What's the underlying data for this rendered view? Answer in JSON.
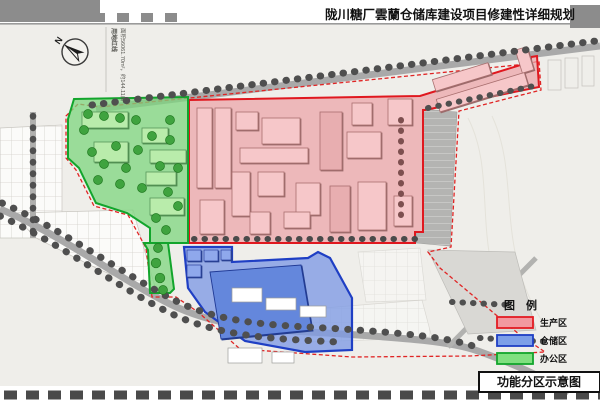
{
  "title": "陇川糖厂雲蘭仓储库建设项目修建性详细规划",
  "caption": "功能分区示意图",
  "compass": {
    "north_label": "N"
  },
  "boundary_note": {
    "line1": "用地红线",
    "line2": "面积56061.70m²，约144.11亩"
  },
  "legend": {
    "title": "图  例",
    "items": [
      {
        "label": "生产区",
        "fill": "#f2989f",
        "border": "#e31b22"
      },
      {
        "label": "仓储区",
        "fill": "#7d9fe8",
        "border": "#1f3fc4"
      },
      {
        "label": "办公区",
        "fill": "#80e080",
        "border": "#12a52c"
      }
    ]
  },
  "zones": {
    "production": {
      "name": "生产区",
      "fill": "#eba3a7",
      "border": "#e0181f"
    },
    "storage": {
      "name": "仓储区",
      "fill": "#7d9ae4",
      "border": "#1f3fc4"
    },
    "office": {
      "name": "办公区",
      "fill": "#7ed67e",
      "border": "#12a52c"
    }
  },
  "colors": {
    "sheet": "#efeeea",
    "road": "#a9a9a9",
    "tree_dark": "#4f4f4f",
    "tree_green": "#3fa33f",
    "boundary_dash": "#e02424",
    "frame_block": "#8c8c8c"
  }
}
